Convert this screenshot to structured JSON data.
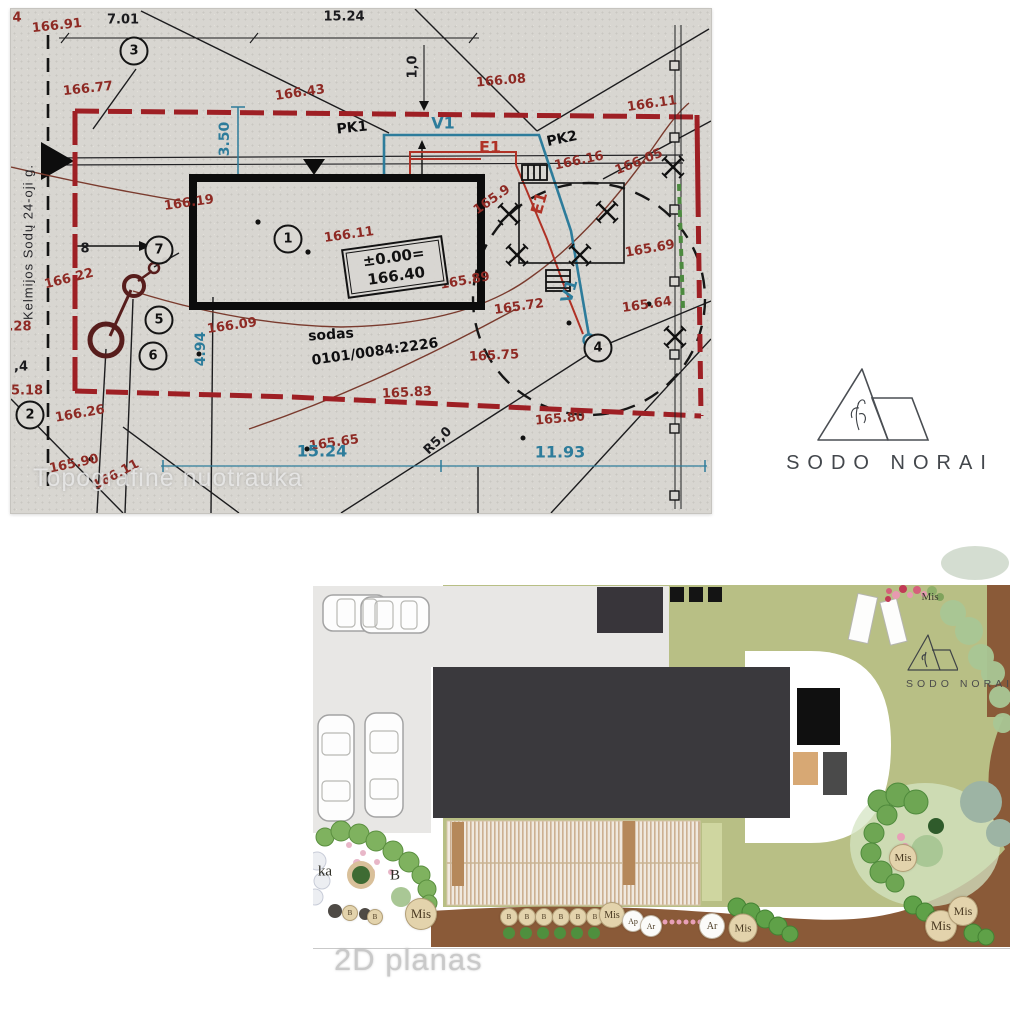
{
  "survey": {
    "watermark": "Topografinė nuotrauka",
    "street": "Kelmijos Sodų 24-oji g.",
    "parcel_number": "0101/0084:2226",
    "level_box": {
      "line1": "±0.00=",
      "line2": "166.40"
    },
    "labels": [
      {
        "t": "4",
        "x": 6,
        "y": 9,
        "r": 0,
        "c": "r"
      },
      {
        "t": "166.91",
        "x": 46,
        "y": 17,
        "r": -6,
        "c": "r"
      },
      {
        "t": "7.01",
        "x": 112,
        "y": 11,
        "r": 0,
        "c": "k"
      },
      {
        "t": "15.24",
        "x": 333,
        "y": 8,
        "r": 0,
        "c": "k"
      },
      {
        "t": "166.77",
        "x": 77,
        "y": 80,
        "r": -6,
        "c": "r"
      },
      {
        "t": "166.43",
        "x": 289,
        "y": 84,
        "r": -8,
        "c": "r"
      },
      {
        "t": "166.08",
        "x": 490,
        "y": 72,
        "r": -5,
        "c": "r"
      },
      {
        "t": "166.11",
        "x": 641,
        "y": 95,
        "r": -8,
        "c": "r"
      },
      {
        "t": "1,0",
        "x": 402,
        "y": 58,
        "r": -90,
        "c": "k"
      },
      {
        "t": "PK1",
        "x": 341,
        "y": 119,
        "r": -6,
        "c": "kb"
      },
      {
        "t": "V1",
        "x": 432,
        "y": 114,
        "r": 0,
        "c": "tb"
      },
      {
        "t": "E1",
        "x": 479,
        "y": 138,
        "r": 0,
        "c": "cb"
      },
      {
        "t": "PK2",
        "x": 551,
        "y": 130,
        "r": -12,
        "c": "kb"
      },
      {
        "t": "166.16",
        "x": 568,
        "y": 152,
        "r": -12,
        "c": "r"
      },
      {
        "t": "166.05",
        "x": 628,
        "y": 153,
        "r": -22,
        "c": "r"
      },
      {
        "t": "3.50",
        "x": 214,
        "y": 130,
        "r": -90,
        "c": "t"
      },
      {
        "t": "166.19",
        "x": 178,
        "y": 194,
        "r": -8,
        "c": "r"
      },
      {
        "t": "165.9",
        "x": 481,
        "y": 191,
        "r": -35,
        "c": "r"
      },
      {
        "t": "E1",
        "x": 528,
        "y": 194,
        "r": -74,
        "c": "cb"
      },
      {
        "t": "166.11",
        "x": 338,
        "y": 226,
        "r": -8,
        "c": "r"
      },
      {
        "t": "165.69",
        "x": 639,
        "y": 240,
        "r": -10,
        "c": "r"
      },
      {
        "t": "166.22",
        "x": 58,
        "y": 270,
        "r": -14,
        "c": "r"
      },
      {
        "t": "165.89",
        "x": 454,
        "y": 272,
        "r": -10,
        "c": "r"
      },
      {
        "t": "V1",
        "x": 558,
        "y": 282,
        "r": -74,
        "c": "tb"
      },
      {
        "t": "165.72",
        "x": 508,
        "y": 298,
        "r": -8,
        "c": "r"
      },
      {
        "t": "165.64",
        "x": 636,
        "y": 296,
        "r": -8,
        "c": "r"
      },
      {
        "t": "8",
        "x": 74,
        "y": 240,
        "r": 0,
        "c": "k"
      },
      {
        "t": ".28",
        "x": 9,
        "y": 318,
        "r": 0,
        "c": "r"
      },
      {
        "t": "166.09",
        "x": 221,
        "y": 317,
        "r": -8,
        "c": "r"
      },
      {
        "t": "sodas",
        "x": 320,
        "y": 326,
        "r": -4,
        "c": "kb"
      },
      {
        "t": "0101/0084:2226",
        "x": 364,
        "y": 343,
        "r": -8,
        "c": "kb"
      },
      {
        "t": "4.94",
        "x": 190,
        "y": 340,
        "r": -90,
        "c": "t"
      },
      {
        "t": "165.75",
        "x": 483,
        "y": 347,
        "r": -3,
        "c": "r"
      },
      {
        "t": ",4",
        "x": 10,
        "y": 358,
        "r": 0,
        "c": "k"
      },
      {
        "t": "5.18",
        "x": 16,
        "y": 382,
        "r": 0,
        "c": "r"
      },
      {
        "t": "165.83",
        "x": 396,
        "y": 384,
        "r": -3,
        "c": "r"
      },
      {
        "t": "166.26",
        "x": 69,
        "y": 405,
        "r": -10,
        "c": "r"
      },
      {
        "t": "165.80",
        "x": 549,
        "y": 410,
        "r": -5,
        "c": "r"
      },
      {
        "t": "R5,0",
        "x": 427,
        "y": 432,
        "r": -44,
        "c": "k"
      },
      {
        "t": "165.65",
        "x": 323,
        "y": 434,
        "r": -8,
        "c": "r"
      },
      {
        "t": "15.24",
        "x": 311,
        "y": 442,
        "r": 0,
        "c": "tb"
      },
      {
        "t": "11.93",
        "x": 549,
        "y": 443,
        "r": 0,
        "c": "tb"
      },
      {
        "t": "165.90",
        "x": 63,
        "y": 455,
        "r": -12,
        "c": "r"
      },
      {
        "t": "166.11",
        "x": 105,
        "y": 466,
        "r": -28,
        "c": "r"
      },
      {
        "t": "Kelmijos Sodų 24-oji g.",
        "x": 17,
        "y": 233,
        "r": -90,
        "c": "st"
      }
    ],
    "points": [
      {
        "n": "1",
        "x": 277,
        "y": 230
      },
      {
        "n": "2",
        "x": 19,
        "y": 406
      },
      {
        "n": "3",
        "x": 123,
        "y": 42
      },
      {
        "n": "4",
        "x": 587,
        "y": 339
      },
      {
        "n": "5",
        "x": 148,
        "y": 311
      },
      {
        "n": "6",
        "x": 142,
        "y": 347
      },
      {
        "n": "7",
        "x": 148,
        "y": 241
      }
    ]
  },
  "brand": {
    "logo_text": "SODO NORAI"
  },
  "plan": {
    "watermark": "2D planas",
    "logo_text": "SODO NORAI",
    "labels": [
      {
        "t": "Mis",
        "x": 617,
        "y": 52,
        "k": "txt"
      },
      {
        "t": "ka",
        "x": 12,
        "y": 327,
        "k": "txtb"
      },
      {
        "t": "B",
        "x": 82,
        "y": 331,
        "k": "txtb"
      },
      {
        "t": "B",
        "x": 37,
        "y": 368,
        "k": "ctan",
        "d": 14
      },
      {
        "t": "B",
        "x": 62,
        "y": 372,
        "k": "ctan",
        "d": 14
      },
      {
        "t": "Mis",
        "x": 108,
        "y": 369,
        "k": "ctan",
        "d": 30
      },
      {
        "t": "B",
        "x": 196,
        "y": 372,
        "k": "ctan",
        "d": 16
      },
      {
        "t": "B",
        "x": 214,
        "y": 372,
        "k": "ctan",
        "d": 16
      },
      {
        "t": "B",
        "x": 231,
        "y": 372,
        "k": "ctan",
        "d": 16
      },
      {
        "t": "B",
        "x": 248,
        "y": 372,
        "k": "ctan",
        "d": 16
      },
      {
        "t": "B",
        "x": 265,
        "y": 372,
        "k": "ctan",
        "d": 16
      },
      {
        "t": "B",
        "x": 282,
        "y": 372,
        "k": "ctan",
        "d": 16
      },
      {
        "t": "Mis",
        "x": 299,
        "y": 370,
        "k": "ctan",
        "d": 24
      },
      {
        "t": "Ap",
        "x": 320,
        "y": 376,
        "k": "cwht",
        "d": 20
      },
      {
        "t": "Ar",
        "x": 338,
        "y": 381,
        "k": "cwht",
        "d": 20
      },
      {
        "t": "Ar",
        "x": 399,
        "y": 381,
        "k": "cwht",
        "d": 24
      },
      {
        "t": "Mis",
        "x": 430,
        "y": 383,
        "k": "ctan",
        "d": 27
      },
      {
        "t": "Mis",
        "x": 590,
        "y": 313,
        "k": "ctan",
        "d": 26
      },
      {
        "t": "Mis",
        "x": 628,
        "y": 381,
        "k": "ctan",
        "d": 30
      },
      {
        "t": "Mis",
        "x": 650,
        "y": 366,
        "k": "ctan",
        "d": 28
      }
    ]
  },
  "colors": {
    "boundary_red": "#9e1f24",
    "contour_brown": "#7a3b2e",
    "utility_blue": "#2d7c9b",
    "utility_red": "#b03226",
    "paper_gray": "#d8d6d1",
    "lawn_green": "#b8bf85",
    "soil_brown": "#8a5a38",
    "building_dark": "#3a393d"
  }
}
